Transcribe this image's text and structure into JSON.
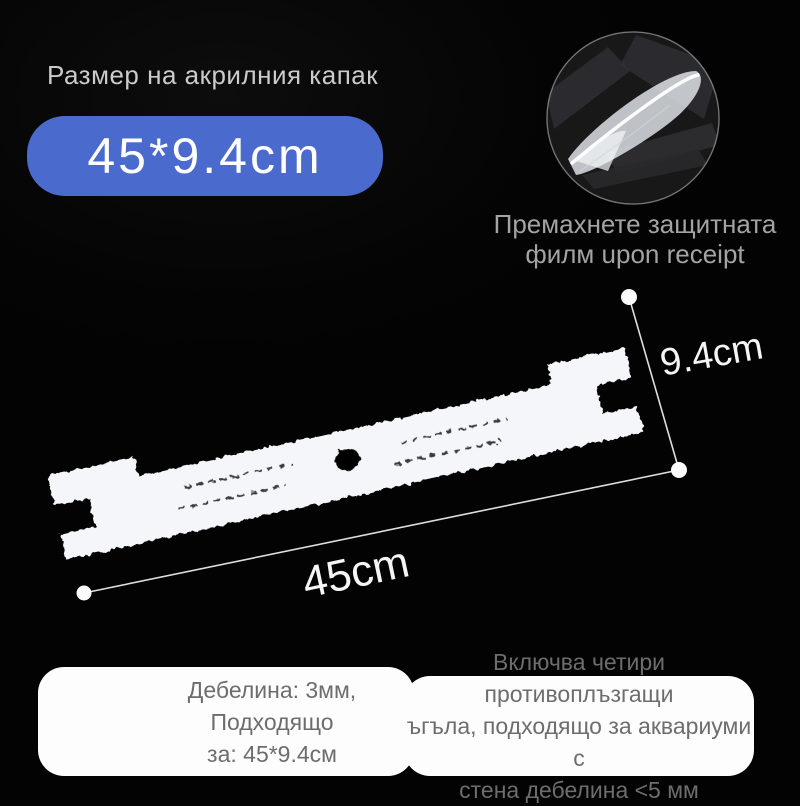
{
  "page": {
    "background_color": "#050505",
    "accent_color": "#4a6bcd",
    "text_light": "#cbcbcb",
    "text_muted": "#a3a3a3",
    "text_card": "#6d6d6d"
  },
  "header": {
    "title": "Размер на акрилния капак"
  },
  "badge": {
    "label": "45*9.4cm"
  },
  "inset": {
    "photo_name": "peeling-protective-film-closeup",
    "caption": "Премахнете защитната\nфилм upon receipt"
  },
  "diagram": {
    "subject": "acrylic-lid-panel",
    "width_label": "45cm",
    "height_label": "9.4cm"
  },
  "footer": {
    "left_note": "Дебелина: 3мм, Подходящо\nза: 45*9.4см",
    "right_note": "Включва четири противоплъзгащи\nъгъла, подходящо за аквариуми с\nстена дебелина <5 мм"
  }
}
